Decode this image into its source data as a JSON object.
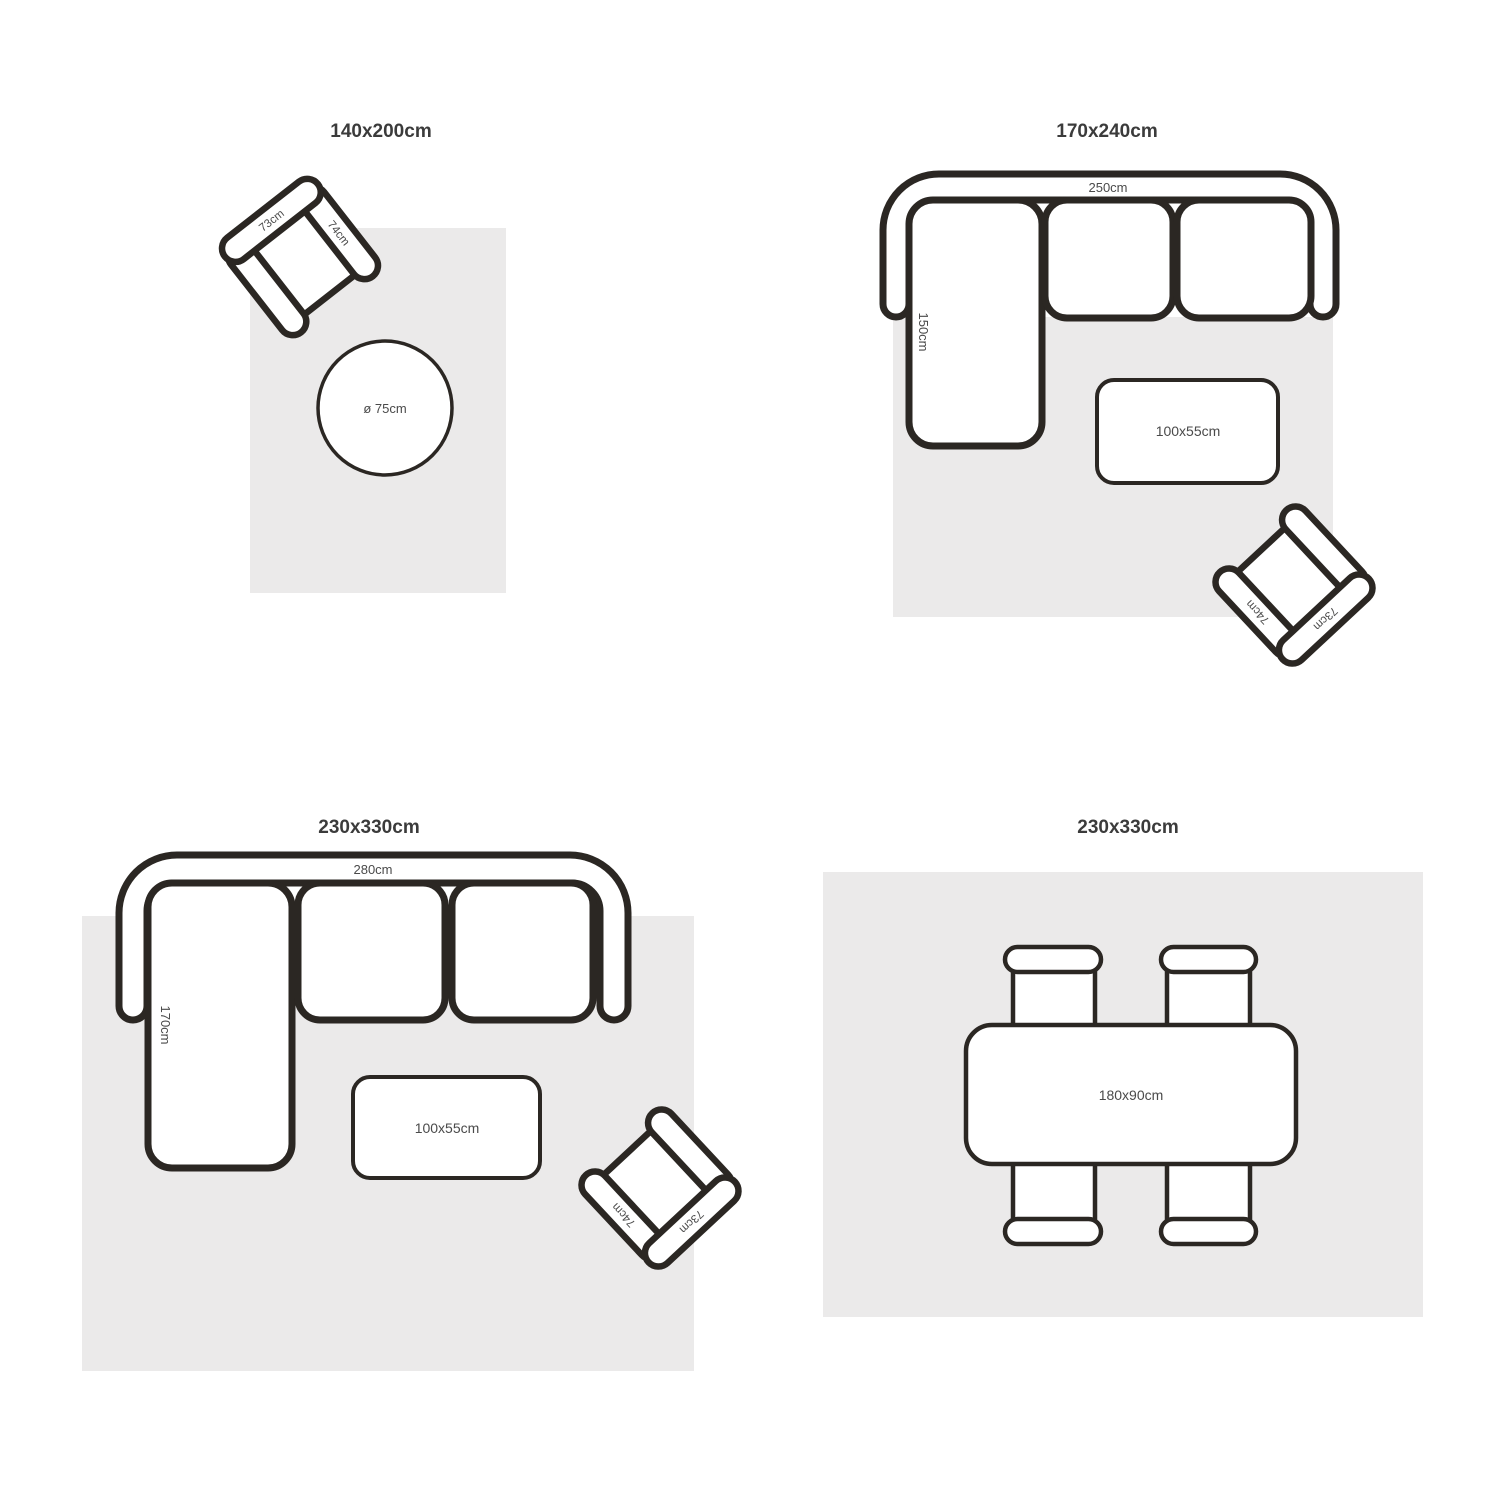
{
  "page": {
    "background": "#ffffff"
  },
  "colors": {
    "rug": "#ebeaea",
    "outline": "#2b2723",
    "furniture_fill": "#ffffff",
    "title_text": "#3b3b3b",
    "dimension_text": "#4a4a4a"
  },
  "panels": [
    {
      "title": "140x200cm",
      "armchair": {
        "back_label": "73cm",
        "arm_label": "74cm"
      },
      "round_table_label": "ø 75cm"
    },
    {
      "title": "170x240cm",
      "sofa": {
        "width_label": "250cm",
        "chaise_label": "150cm"
      },
      "coffee_table_label": "100x55cm",
      "armchair": {
        "back_label": "73cm",
        "arm_label": "74cm"
      }
    },
    {
      "title": "230x330cm",
      "sofa": {
        "width_label": "280cm",
        "chaise_label": "170cm"
      },
      "coffee_table_label": "100x55cm",
      "armchair": {
        "back_label": "73cm",
        "arm_label": "74cm"
      }
    },
    {
      "title": "230x330cm",
      "dining_table_label": "180x90cm"
    }
  ]
}
